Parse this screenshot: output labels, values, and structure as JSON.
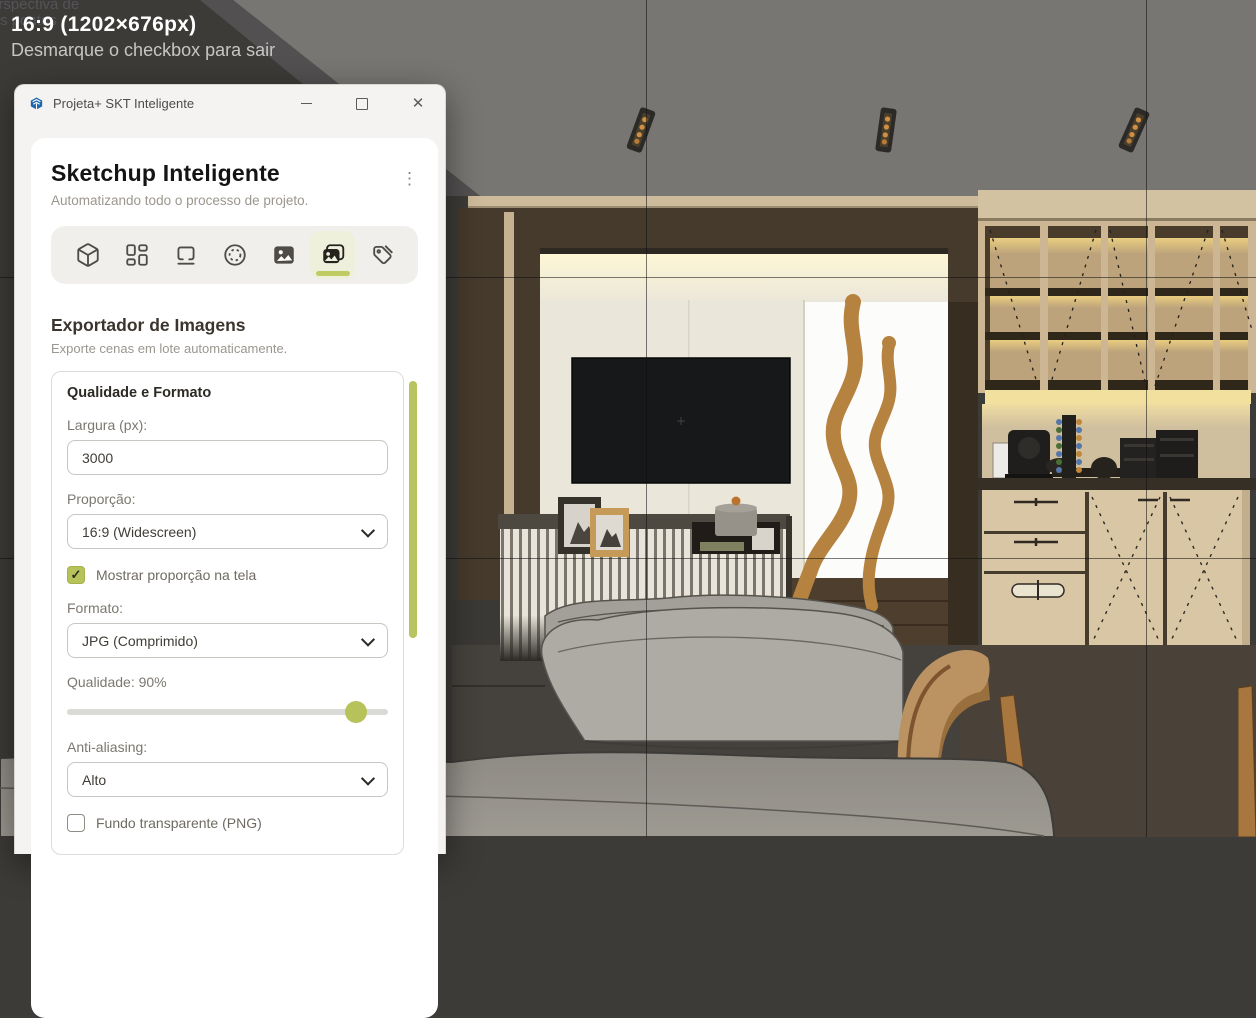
{
  "scene": {
    "camera_label_line1": "Perspectiva de",
    "camera_label_line2": "dois pontos",
    "description": "SketchUp interior render: TV wall alcove, slatted sideboard, sofas, coffee-bar cabinetry"
  },
  "overlay": {
    "aspect_label": "16:9 (1202×676px)",
    "hint": "Desmarque o checkbox para sair"
  },
  "window": {
    "app_title": "Projeta+ SKT Inteligente",
    "controls": {
      "close_glyph": "✕"
    }
  },
  "panel": {
    "title": "Sketchup Inteligente",
    "subtitle": "Automatizando todo o processo de projeto.",
    "menu_icon": "kebab-menu-icon",
    "toolbar": [
      {
        "icon": "cube-icon",
        "active": false
      },
      {
        "icon": "layout-dashboard-icon",
        "active": false
      },
      {
        "icon": "section-plane-icon",
        "active": false
      },
      {
        "icon": "circle-dashed-icon",
        "active": false
      },
      {
        "icon": "image-icon",
        "active": false
      },
      {
        "icon": "image-exporter-icon",
        "active": true
      },
      {
        "icon": "tags-icon",
        "active": false
      }
    ],
    "exporter": {
      "title": "Exportador de Imagens",
      "subtitle": "Exporte cenas em lote automaticamente."
    },
    "form": {
      "card_title": "Qualidade e Formato",
      "width_label": "Largura (px):",
      "width_value": "3000",
      "proportion_label": "Proporção:",
      "proportion_value": "16:9 (Widescreen)",
      "show_proportion_label": "Mostrar proporção na tela",
      "show_proportion_checked": true,
      "format_label": "Formato:",
      "format_value": "JPG (Comprimido)",
      "quality_label": "Qualidade: 90%",
      "quality_percent": 90,
      "antialias_label": "Anti-aliasing:",
      "antialias_value": "Alto",
      "transparent_label": "Fundo transparente (PNG)",
      "transparent_checked": false
    }
  },
  "icons": {
    "check": "✓",
    "kebab": "⋮"
  },
  "colors": {
    "accent": "#b7c25a",
    "accent_underline": "#c0cc62",
    "accent_bg": "#eef0dc",
    "scrollbar": "#b9c35f",
    "logo_blue": "#1b66ae",
    "ceiling_gray": "#787673",
    "alcove_wood": "#463a2c",
    "panel_cream": "#ebe6da",
    "art_brown": "#b5823f"
  }
}
